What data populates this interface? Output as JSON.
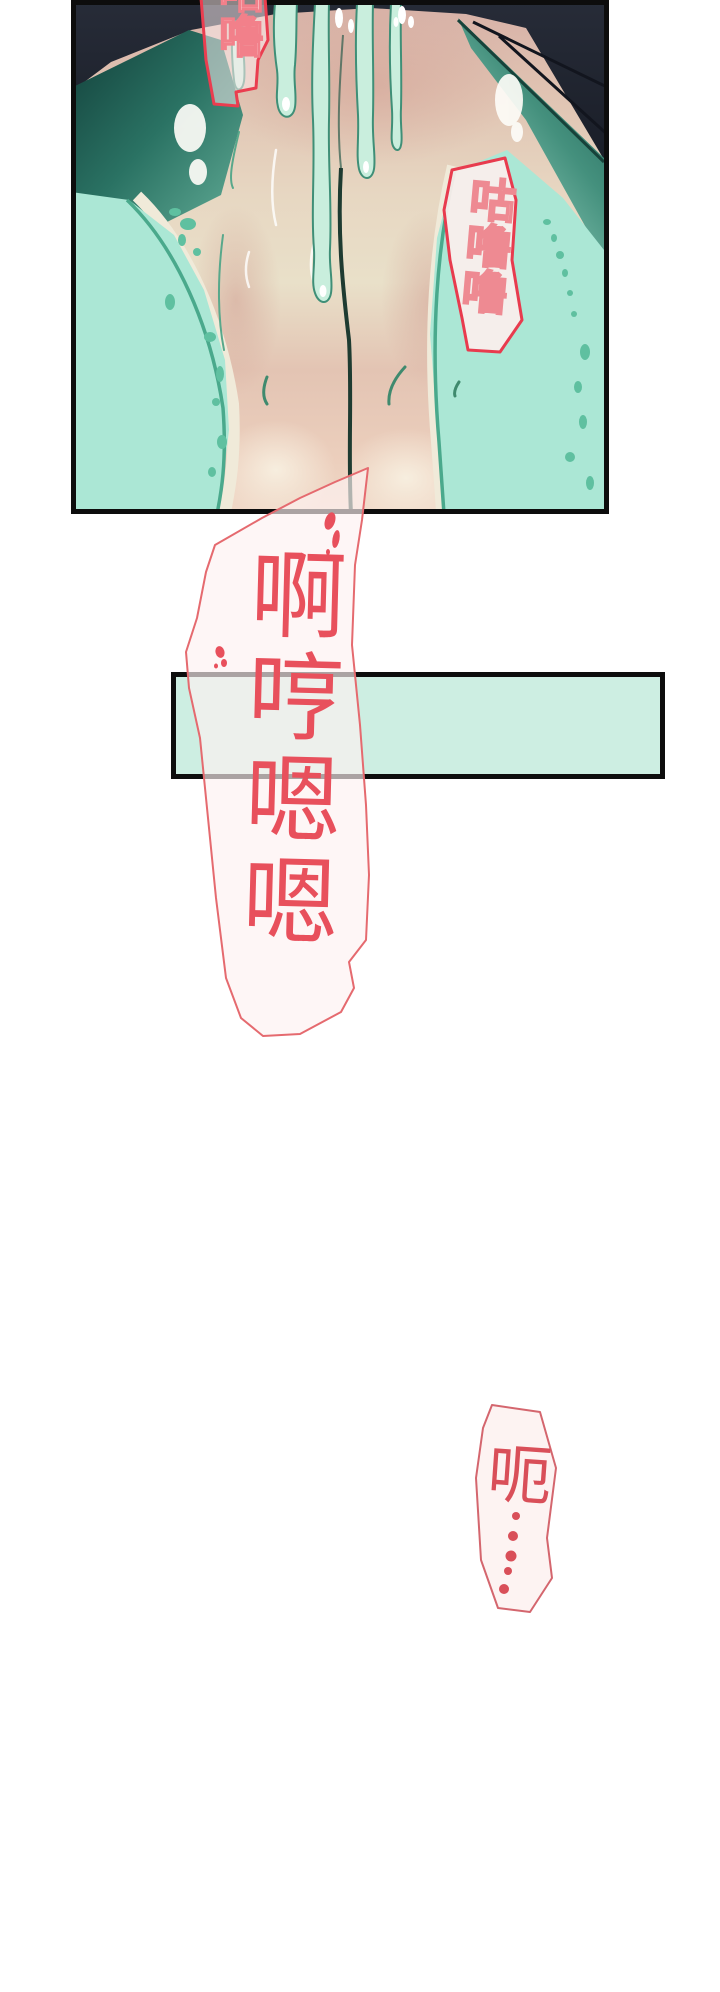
{
  "page": {
    "width": 720,
    "height": 1992,
    "background": "#ffffff"
  },
  "panel": {
    "border_color": "#0d0d0d",
    "palette": {
      "dark_background": "#232834",
      "teal_shadow": "#2a7263",
      "mint_fabric": "#abe7d5",
      "mint_spots": "#5fc0a0",
      "skin_light": "#e9e0c9",
      "skin_pink": "#d7b0a6",
      "fluid_fill": "#c9eedd",
      "fluid_outline": "#3f8f77",
      "highlight_white": "#ffffff"
    },
    "sfx_bubbles": [
      {
        "text": "咕噜",
        "orientation": "vertical",
        "border_color": "#ea3d4f",
        "text_color": "#ffffff",
        "text_outline": "#f2808a",
        "note": "translucent bubble clipped by top edge of page"
      },
      {
        "text": "咕噜噜",
        "orientation": "vertical",
        "border_color": "#e83b4e",
        "fill": "#f9edeb",
        "text_outline": "#ee8a92",
        "note": "hollow outlined lettering, tilted"
      }
    ]
  },
  "divider_bar": {
    "fill": "#cdeee2",
    "border_color": "#0d0d0d"
  },
  "main_speech_bubble": {
    "text": "啊哼嗯嗯",
    "orientation": "vertical",
    "text_color": "#e8505c",
    "outline_color": "#e56a6f",
    "fill": "rgba(253,242,242,0.66)",
    "splatter_color": "#e8505c"
  },
  "small_speech_bubble": {
    "text": "呃",
    "orientation": "vertical",
    "ellipsis_dots": 5,
    "text_color": "#d94f59",
    "outline_color": "#d4666e",
    "fill": "#fdf3f2"
  }
}
